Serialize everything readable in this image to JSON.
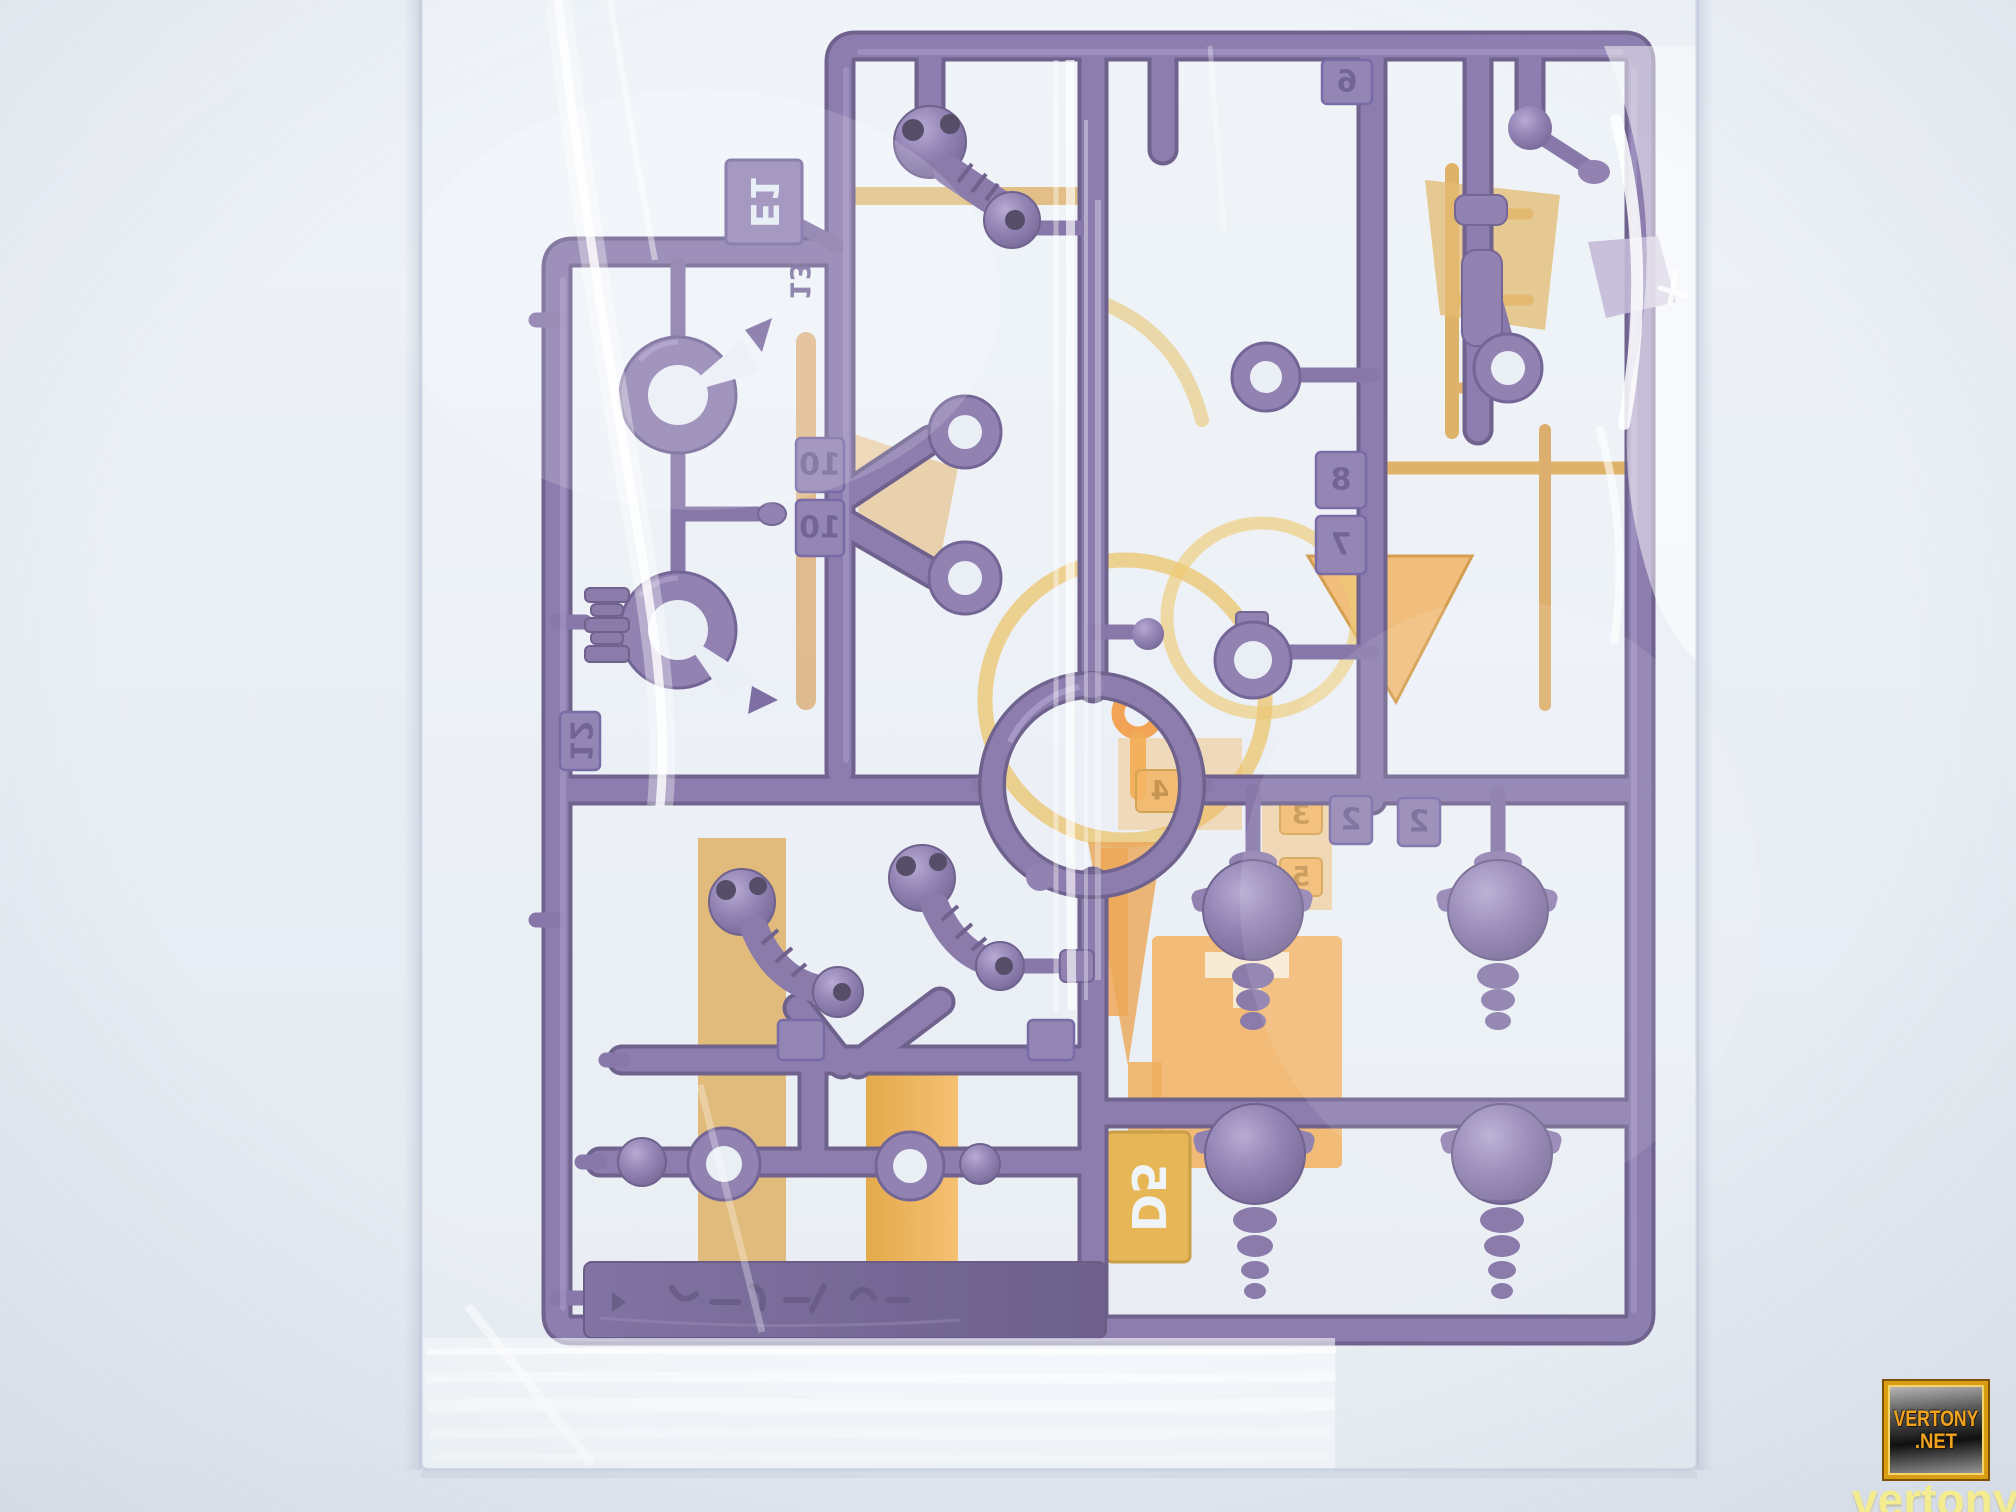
{
  "photo": {
    "alt": "Dark purple model-kit parts runner sealed inside a clear plastic bag, with a translucent orange runner behind it, photographed on a white lightbox"
  },
  "purple_runner": {
    "tag_label": "E1",
    "molded_number": "13",
    "number_tabs": [
      "10",
      "10",
      "12",
      "6",
      "8",
      "7",
      "2",
      "2"
    ]
  },
  "orange_runner": {
    "tag_label": "D5",
    "number_tabs": [
      "4",
      "3",
      "5"
    ]
  },
  "watermark": {
    "badge_line1": "VERTONY",
    "badge_line2": ".NET",
    "tagline": "vertony.net"
  },
  "colors": {
    "background": "#e9edf4",
    "bag_highlight": "#ffffff",
    "purple": "#77639f",
    "purple_dark": "#4d3b71",
    "purple_light": "#b7abce",
    "orange_bright": "#ef8f1c",
    "orange_ochre": "#d69a34",
    "badge_gold": "#d89d15",
    "badge_text": "#f2a41f",
    "tagline_yellow": "#f4ec8a"
  }
}
